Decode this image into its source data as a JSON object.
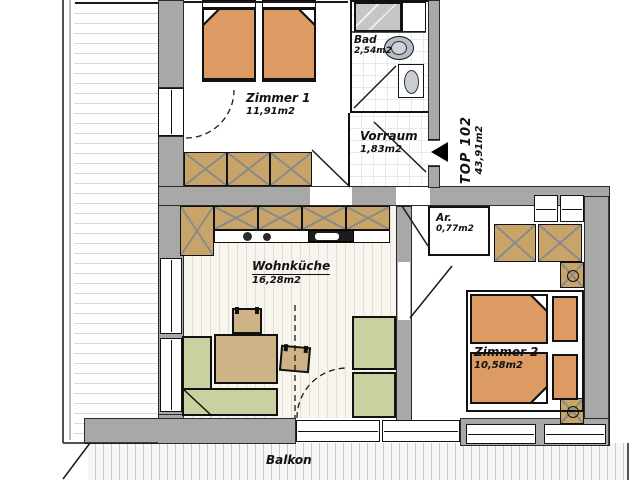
{
  "unit": {
    "label": "TOP 102",
    "area": "43,91m2"
  },
  "rooms": {
    "zimmer1": {
      "name": "Zimmer 1",
      "area": "11,91m2"
    },
    "bad": {
      "name": "Bad",
      "area": "2,54m2"
    },
    "vorraum": {
      "name": "Vorraum",
      "area": "1,83m2"
    },
    "abstellraum": {
      "name": "Ar.",
      "area": "0,77m2"
    },
    "wohnkueche": {
      "name": "Wohnküche",
      "area": "16,28m2"
    },
    "zimmer2": {
      "name": "Zimmer 2",
      "area": "10,58m2"
    },
    "balkon": {
      "name": "Balkon"
    }
  },
  "colors": {
    "wall": "#a8a8a8",
    "line": "#1a1a1a",
    "bed": "#dc9b62",
    "cabinet": "#c8a468",
    "table": "#cdb386",
    "upholstery": "#c9d1a0",
    "fixture": "#b9bec6"
  }
}
